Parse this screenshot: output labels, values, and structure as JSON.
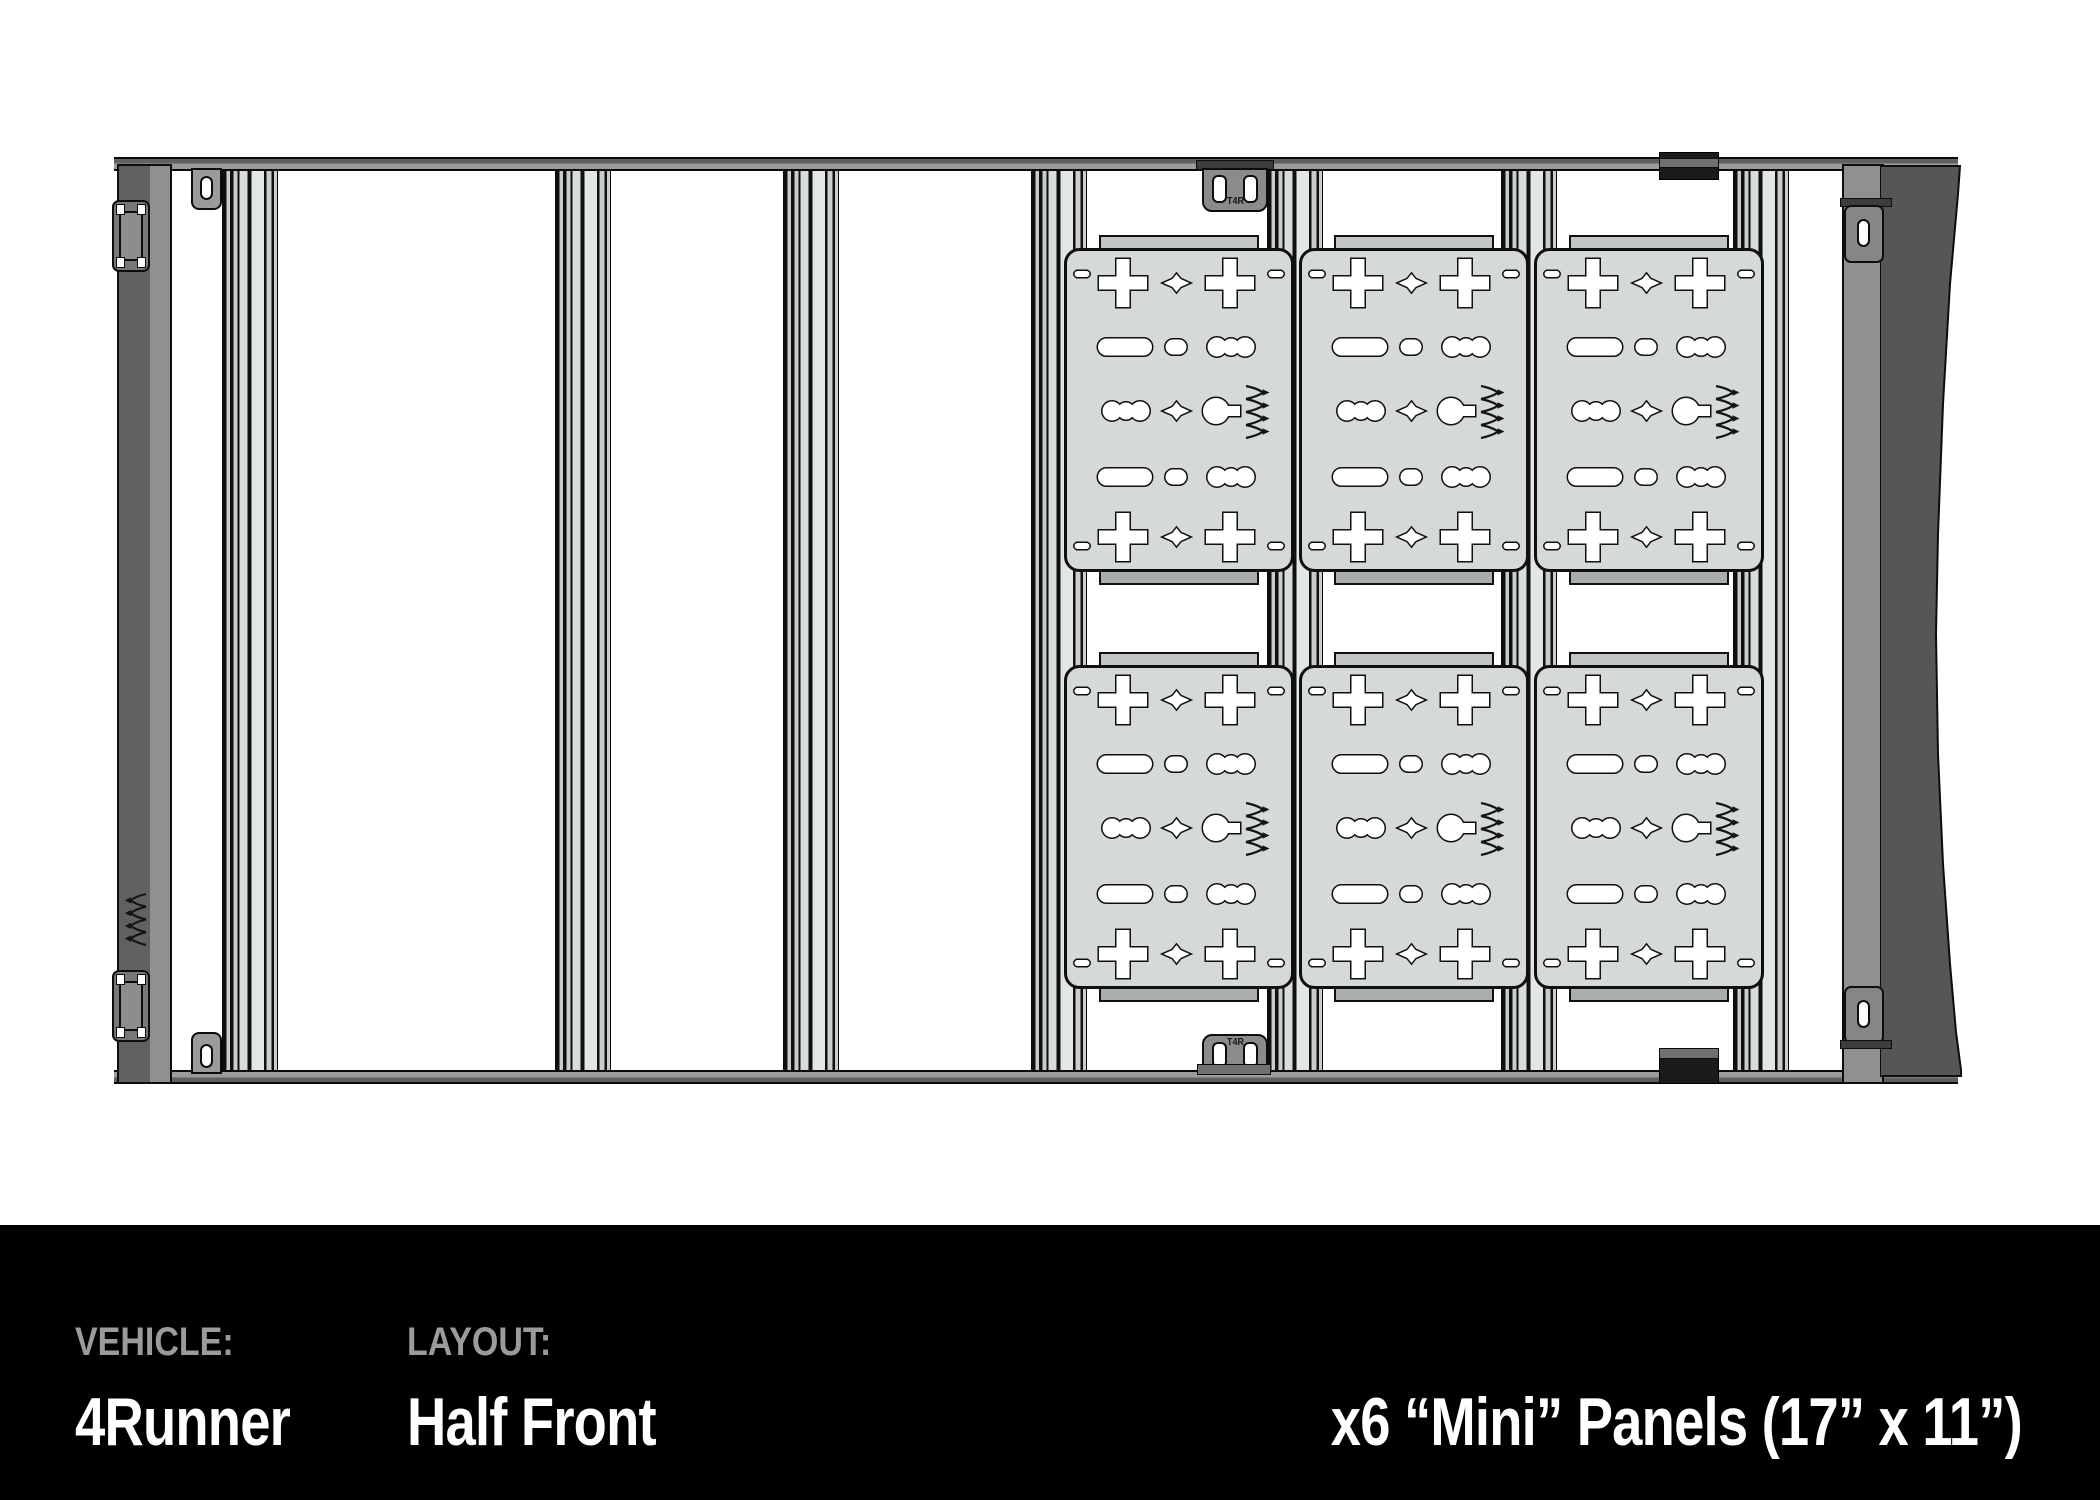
{
  "footer": {
    "vehicle_label": "VEHICLE:",
    "vehicle_value": "4Runner",
    "layout_label": "LAYOUT:",
    "layout_value": "Half Front",
    "panels_note": "x6 “Mini” Panels (17” x 11”)",
    "label_color": "#9b9b9b",
    "value_color": "#ffffff",
    "bg_color": "#000000"
  },
  "diagram": {
    "description": "Top view CAD drawing of roof rack: 7 crossbars, slotted side rails, 6 perforated mini panels",
    "bracket_text": "T4R",
    "colors": {
      "panel_fill": "#d5d9d8",
      "backing": "#c1c5c4",
      "plate_dark": "#606261",
      "flange": "#8f9190",
      "shape_dark": "#555757",
      "outline": "#101010"
    },
    "crossbars": {
      "count": 7,
      "centers_x": [
        249,
        582,
        810,
        1058,
        1294,
        1528,
        1760
      ],
      "width": 54,
      "top": 168,
      "bottom": 1073
    },
    "panel_grid": {
      "count": 6,
      "cols_x": [
        1064,
        1299,
        1534
      ],
      "rows_y": [
        248,
        665
      ],
      "width": 230,
      "height": 324
    },
    "left_slots_y": [
      194,
      576,
      958
    ],
    "right_slots": [
      {
        "y": 174,
        "h": 24
      },
      {
        "y": 258,
        "h": 52
      },
      {
        "y": 338,
        "h": 86
      },
      {
        "y": 458,
        "h": 86
      },
      {
        "y": 588,
        "h": 86
      },
      {
        "y": 718,
        "h": 86
      },
      {
        "y": 848,
        "h": 86
      },
      {
        "y": 966,
        "h": 84
      }
    ],
    "right_dot_pairs_y": [
      230,
      485,
      740,
      995
    ]
  }
}
